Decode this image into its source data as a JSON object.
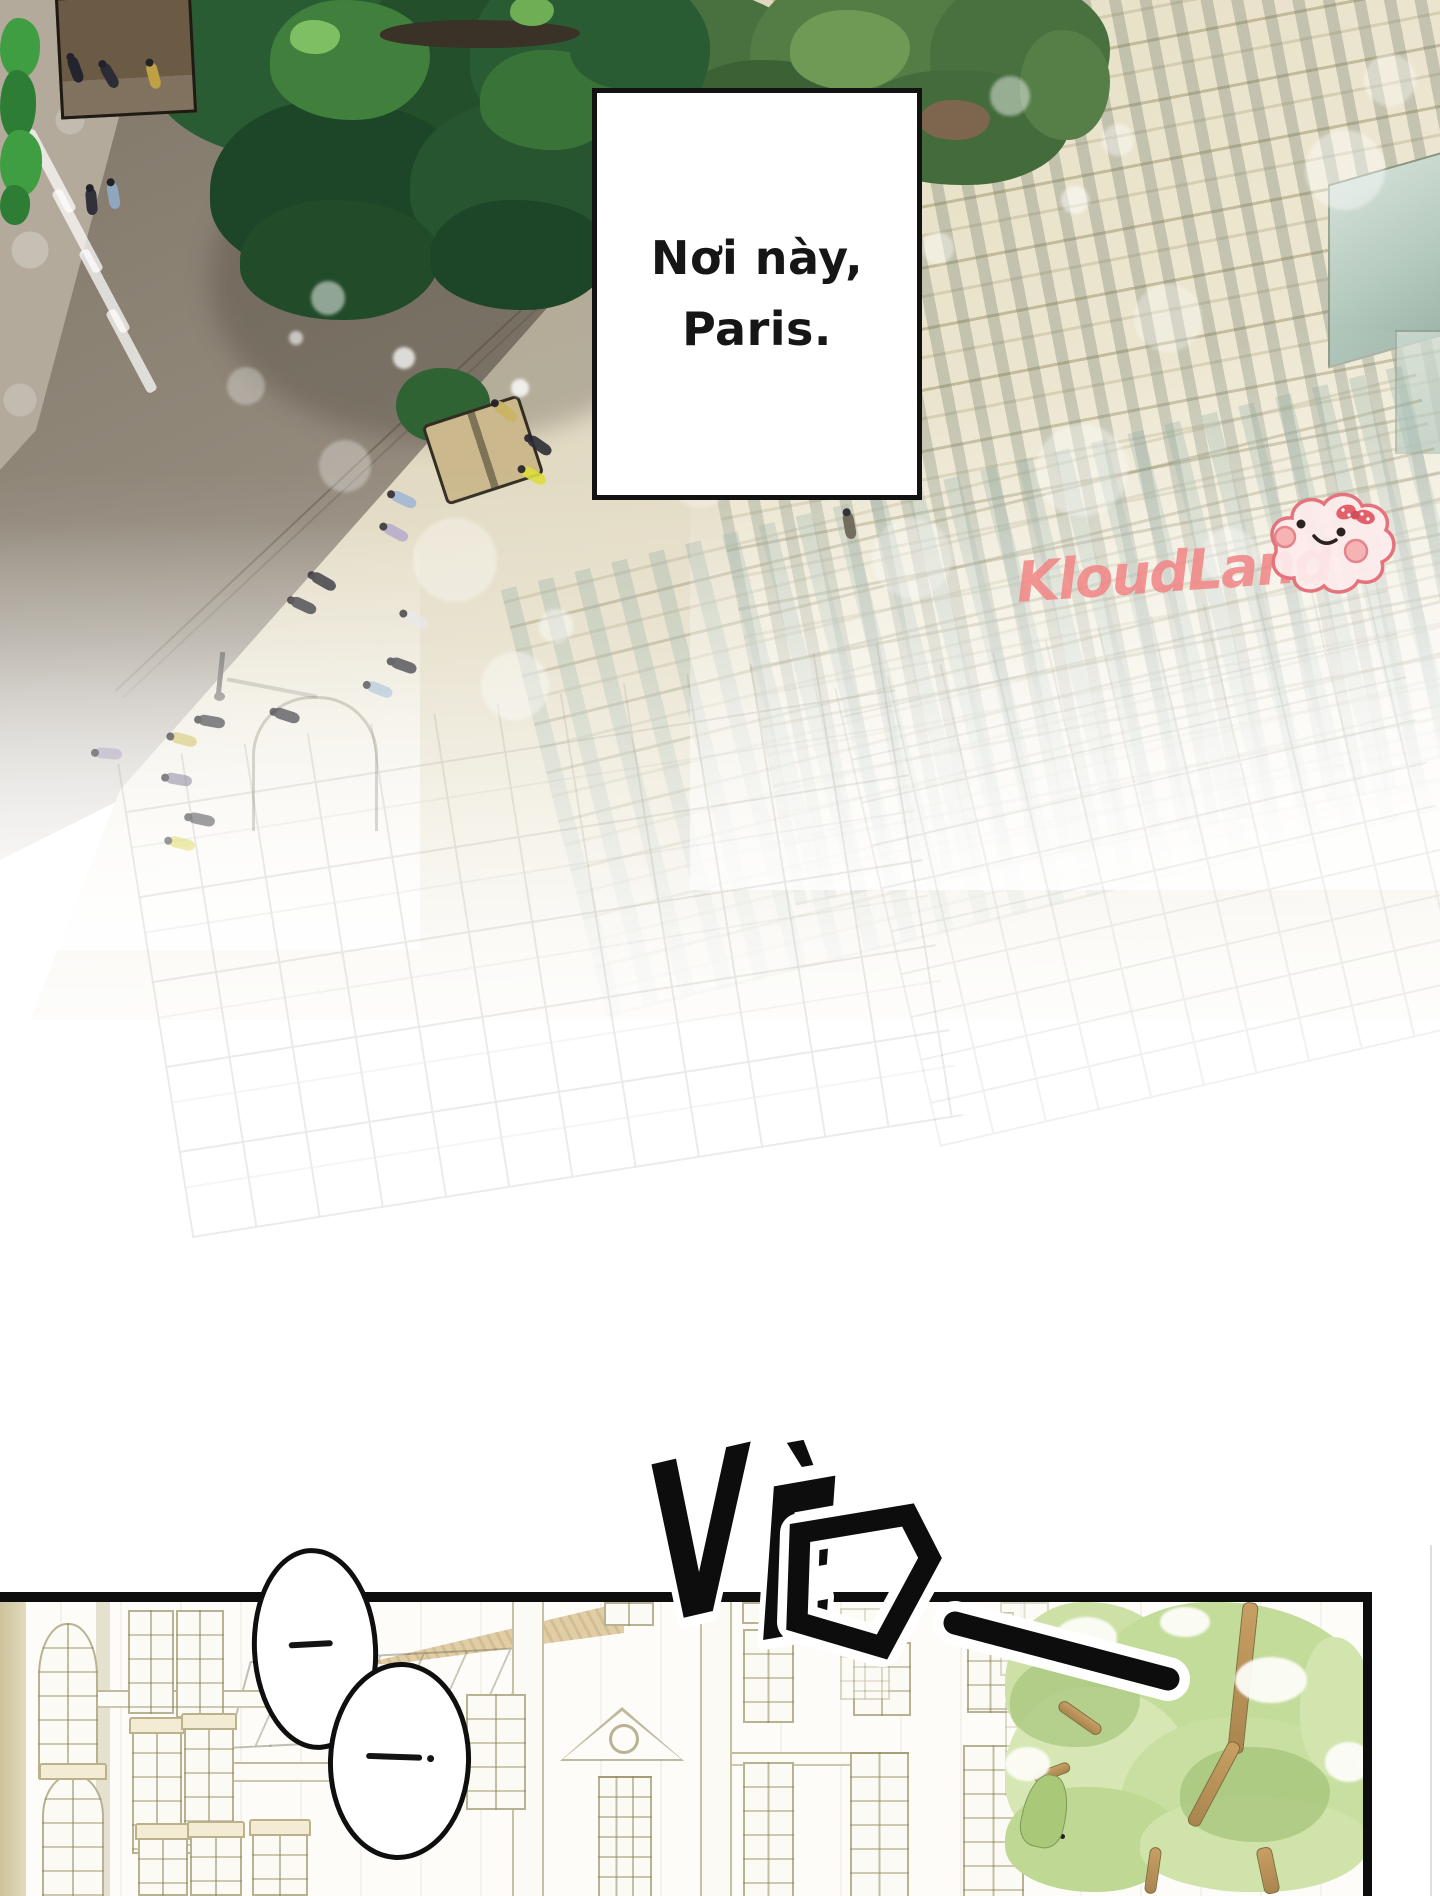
{
  "page": {
    "width": 1440,
    "height": 1896,
    "background": "#ffffff"
  },
  "caption": {
    "line1": "Nơi này,",
    "line2": "Paris."
  },
  "watermark": {
    "text": "KloudLand",
    "color": "#f08686",
    "mascot": "cloud-face-with-bow"
  },
  "sfx": {
    "label": "VÈO",
    "v": "V",
    "e": "È",
    "o": "O",
    "trailing_mark": "—"
  },
  "bubbles": [
    {
      "label": "—"
    },
    {
      "label": "—."
    }
  ],
  "colors": {
    "ink": "#101010",
    "road": "#968d7f",
    "plaza": "#b3aa9b",
    "tree_dark": "#2a5c33",
    "tree_olive": "#4d7440",
    "building_cream": "#ece6cf",
    "glass_teal": "#b4c9bd",
    "panel_line": "#958b5d",
    "panel_tree": "#cfe3ab",
    "watermark_pink": "#f08686"
  },
  "scene": {
    "people": [
      [
        62,
        64,
        70,
        "#23242e",
        1
      ],
      [
        96,
        70,
        60,
        "#2b2c36",
        1
      ],
      [
        140,
        70,
        75,
        "#bfa043",
        1
      ],
      [
        100,
        190,
        80,
        "#8fa6bd",
        1
      ],
      [
        78,
        196,
        85,
        "#30313b",
        1
      ],
      [
        492,
        406,
        40,
        "#c9b464",
        0.95
      ],
      [
        526,
        440,
        35,
        "#2c2d37",
        0.9
      ],
      [
        520,
        470,
        30,
        "#dddd3f",
        0.9
      ],
      [
        390,
        494,
        25,
        "#9db7d6",
        0.85
      ],
      [
        382,
        527,
        28,
        "#b3a8cc",
        0.8
      ],
      [
        310,
        576,
        30,
        "#2c2d37",
        0.75
      ],
      [
        290,
        600,
        25,
        "#33343e",
        0.7
      ],
      [
        402,
        614,
        28,
        "#e9e9ee",
        0.7
      ],
      [
        390,
        660,
        20,
        "#2c2d37",
        0.65
      ],
      [
        366,
        684,
        22,
        "#aac3dd",
        0.6
      ],
      [
        273,
        710,
        18,
        "#2c2d37",
        0.6
      ],
      [
        198,
        716,
        10,
        "#3a3b44",
        0.6
      ],
      [
        170,
        734,
        15,
        "#d6ca76",
        0.6
      ],
      [
        95,
        748,
        5,
        "#b5aacb",
        0.5
      ],
      [
        165,
        774,
        10,
        "#8d86a0",
        0.55
      ],
      [
        188,
        814,
        12,
        "#42434c",
        0.5
      ],
      [
        168,
        838,
        14,
        "#dcd84e",
        0.45
      ],
      [
        836,
        520,
        80,
        "#6b6456",
        0.9
      ]
    ],
    "bokeh": [
      [
        328,
        298,
        17,
        0.5
      ],
      [
        404,
        358,
        11,
        0.75
      ],
      [
        455,
        560,
        42,
        0.35
      ],
      [
        515,
        686,
        34,
        0.4
      ],
      [
        345,
        466,
        26,
        0.3
      ],
      [
        246,
        386,
        19,
        0.3
      ],
      [
        556,
        626,
        17,
        0.45
      ],
      [
        700,
        478,
        30,
        0.3
      ],
      [
        912,
        558,
        40,
        0.3
      ],
      [
        1082,
        470,
        46,
        0.35
      ],
      [
        1168,
        318,
        34,
        0.3
      ],
      [
        1230,
        556,
        28,
        0.35
      ],
      [
        938,
        248,
        16,
        0.4
      ],
      [
        1010,
        96,
        20,
        0.45
      ],
      [
        1118,
        140,
        16,
        0.4
      ],
      [
        520,
        388,
        9,
        0.8
      ],
      [
        296,
        338,
        7,
        0.6
      ],
      [
        906,
        238,
        10,
        0.5
      ],
      [
        1345,
        170,
        40,
        0.4
      ],
      [
        1390,
        80,
        26,
        0.35
      ],
      [
        1075,
        200,
        14,
        0.5
      ]
    ],
    "trees": [
      {
        "x": 590,
        "y": -30,
        "w": 520,
        "h": 215,
        "blobs": [
          [
            0,
            20,
            220,
            160,
            "#49703f"
          ],
          [
            160,
            0,
            240,
            170,
            "#547c45"
          ],
          [
            340,
            10,
            180,
            150,
            "#49703f"
          ],
          [
            80,
            90,
            200,
            120,
            "#3c6134"
          ],
          [
            260,
            100,
            220,
            115,
            "#446b3b"
          ],
          [
            430,
            60,
            90,
            110,
            "#567e47"
          ],
          [
            200,
            40,
            120,
            80,
            "#6f9a55"
          ],
          [
            120,
            120,
            60,
            40,
            "#8a7156"
          ],
          [
            330,
            130,
            70,
            40,
            "#7d664d"
          ]
        ]
      },
      {
        "x": 150,
        "y": -40,
        "w": 560,
        "h": 420,
        "blobs": [
          [
            0,
            0,
            300,
            200,
            "#2a5c33"
          ],
          [
            180,
            20,
            280,
            220,
            "#234f2b"
          ],
          [
            320,
            0,
            240,
            190,
            "#2a5c33"
          ],
          [
            60,
            140,
            260,
            180,
            "#1d4527"
          ],
          [
            260,
            140,
            240,
            170,
            "#265530"
          ],
          [
            120,
            40,
            160,
            120,
            "#417f3c"
          ],
          [
            330,
            90,
            140,
            100,
            "#3a7337"
          ],
          [
            420,
            40,
            120,
            90,
            "#2a5c33"
          ],
          [
            90,
            240,
            200,
            120,
            "#224b2a"
          ],
          [
            280,
            240,
            180,
            110,
            "#1d4527"
          ],
          [
            230,
            60,
            200,
            28,
            "#3a3226"
          ],
          [
            140,
            60,
            50,
            34,
            "#7fbf63"
          ],
          [
            360,
            36,
            44,
            30,
            "#6fae55"
          ]
        ]
      }
    ],
    "bushes_left": [
      [
        0,
        18,
        40,
        60,
        "#3f9e42"
      ],
      [
        0,
        70,
        36,
        70,
        "#2e7d35"
      ],
      [
        0,
        130,
        42,
        66,
        "#3f9e42"
      ],
      [
        0,
        185,
        30,
        40,
        "#2e7d35"
      ]
    ],
    "crosswalk_stripes": [
      [
        45,
        125
      ],
      [
        72,
        185
      ],
      [
        99,
        245
      ],
      [
        126,
        305
      ]
    ]
  },
  "panel": {
    "windows": [
      [
        38,
        21,
        56,
        152,
        "a"
      ],
      [
        42,
        172,
        58,
        120,
        "aw"
      ],
      [
        128,
        8,
        42,
        100,
        ""
      ],
      [
        176,
        8,
        44,
        104,
        ""
      ],
      [
        132,
        126,
        46,
        122,
        "w"
      ],
      [
        184,
        122,
        46,
        126,
        "w"
      ],
      [
        138,
        232,
        46,
        58,
        "w"
      ],
      [
        190,
        230,
        48,
        60,
        "w"
      ],
      [
        252,
        228,
        52,
        62,
        "w"
      ],
      [
        466,
        92,
        56,
        112,
        ""
      ],
      [
        604,
        0,
        46,
        20,
        ""
      ],
      [
        742,
        0,
        40,
        18,
        ""
      ],
      [
        598,
        174,
        50,
        120,
        "d"
      ],
      [
        743,
        27,
        47,
        90,
        ""
      ],
      [
        853,
        40,
        54,
        70,
        ""
      ],
      [
        967,
        10,
        43,
        97,
        ""
      ],
      [
        743,
        160,
        47,
        134,
        ""
      ],
      [
        850,
        150,
        55,
        144,
        ""
      ],
      [
        963,
        143,
        57,
        151,
        ""
      ],
      [
        840,
        6,
        46,
        88,
        "f"
      ],
      [
        1000,
        0,
        45,
        70,
        "f"
      ],
      [
        1005,
        100,
        45,
        90,
        "f"
      ]
    ],
    "pilasters": [
      512,
      700
    ],
    "cornices": [
      [
        52,
        88,
        350,
        14
      ],
      [
        222,
        160,
        300,
        16
      ],
      [
        700,
        150,
        180,
        10
      ]
    ],
    "tree": {
      "blobs": [
        [
          0,
          0,
          175,
          160,
          "#cde1a6"
        ],
        [
          75,
          0,
          290,
          215,
          "#c3dc9a"
        ],
        [
          0,
          85,
          185,
          170,
          "#d6e7b4"
        ],
        [
          115,
          115,
          250,
          175,
          "#c9dfa1"
        ],
        [
          0,
          185,
          175,
          105,
          "#bfd894"
        ],
        [
          135,
          195,
          230,
          95,
          "#cfe3ab"
        ],
        [
          295,
          35,
          72,
          140,
          "#d2e5ae"
        ],
        [
          5,
          55,
          130,
          90,
          "rgba(166,197,122,0.7)"
        ],
        [
          175,
          145,
          150,
          95,
          "rgba(160,192,115,0.65)"
        ]
      ],
      "holes": [
        [
          50,
          15,
          62,
          42
        ],
        [
          230,
          55,
          72,
          46
        ],
        [
          0,
          145,
          45,
          34
        ],
        [
          320,
          140,
          47,
          40
        ],
        [
          155,
          5,
          50,
          30
        ]
      ],
      "branches": [
        [
          230,
          0,
          14,
          150,
          6
        ],
        [
          202,
          135,
          12,
          92,
          28
        ],
        [
          255,
          245,
          14,
          45,
          -12
        ],
        [
          50,
          110,
          48,
          10,
          35
        ],
        [
          28,
          165,
          36,
          9,
          -20
        ],
        [
          142,
          245,
          10,
          45,
          8
        ]
      ],
      "dots": [
        [
          35,
          210
        ],
        [
          51,
          217
        ],
        [
          55,
          232
        ]
      ]
    }
  }
}
